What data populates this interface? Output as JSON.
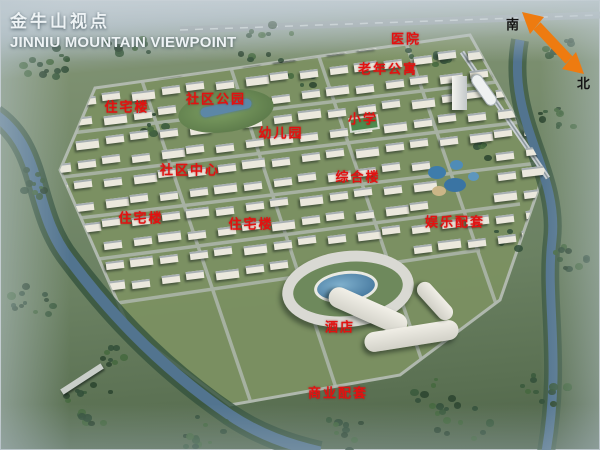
{
  "header": {
    "title_zh": "金牛山视点",
    "title_en": "JINNIU MOUNTAIN VIEWPOINT"
  },
  "compass": {
    "south_label": "南",
    "north_label": "北",
    "arrow_color": "#ee7b10"
  },
  "label_style": {
    "color": "#e31110"
  },
  "map_labels": [
    {
      "text": "医院",
      "x": 406,
      "y": 38
    },
    {
      "text": "老年公寓",
      "x": 388,
      "y": 68
    },
    {
      "text": "社区公园",
      "x": 216,
      "y": 98
    },
    {
      "text": "住宅楼",
      "x": 127,
      "y": 106
    },
    {
      "text": "小学",
      "x": 363,
      "y": 118
    },
    {
      "text": "幼儿园",
      "x": 281,
      "y": 132
    },
    {
      "text": "社区中心",
      "x": 190,
      "y": 169
    },
    {
      "text": "综合楼",
      "x": 358,
      "y": 176
    },
    {
      "text": "住宅楼",
      "x": 141,
      "y": 217
    },
    {
      "text": "住宅楼",
      "x": 251,
      "y": 223
    },
    {
      "text": "娱乐配套",
      "x": 455,
      "y": 221
    },
    {
      "text": "酒店",
      "x": 340,
      "y": 326
    },
    {
      "text": "商业配套",
      "x": 338,
      "y": 392
    }
  ]
}
